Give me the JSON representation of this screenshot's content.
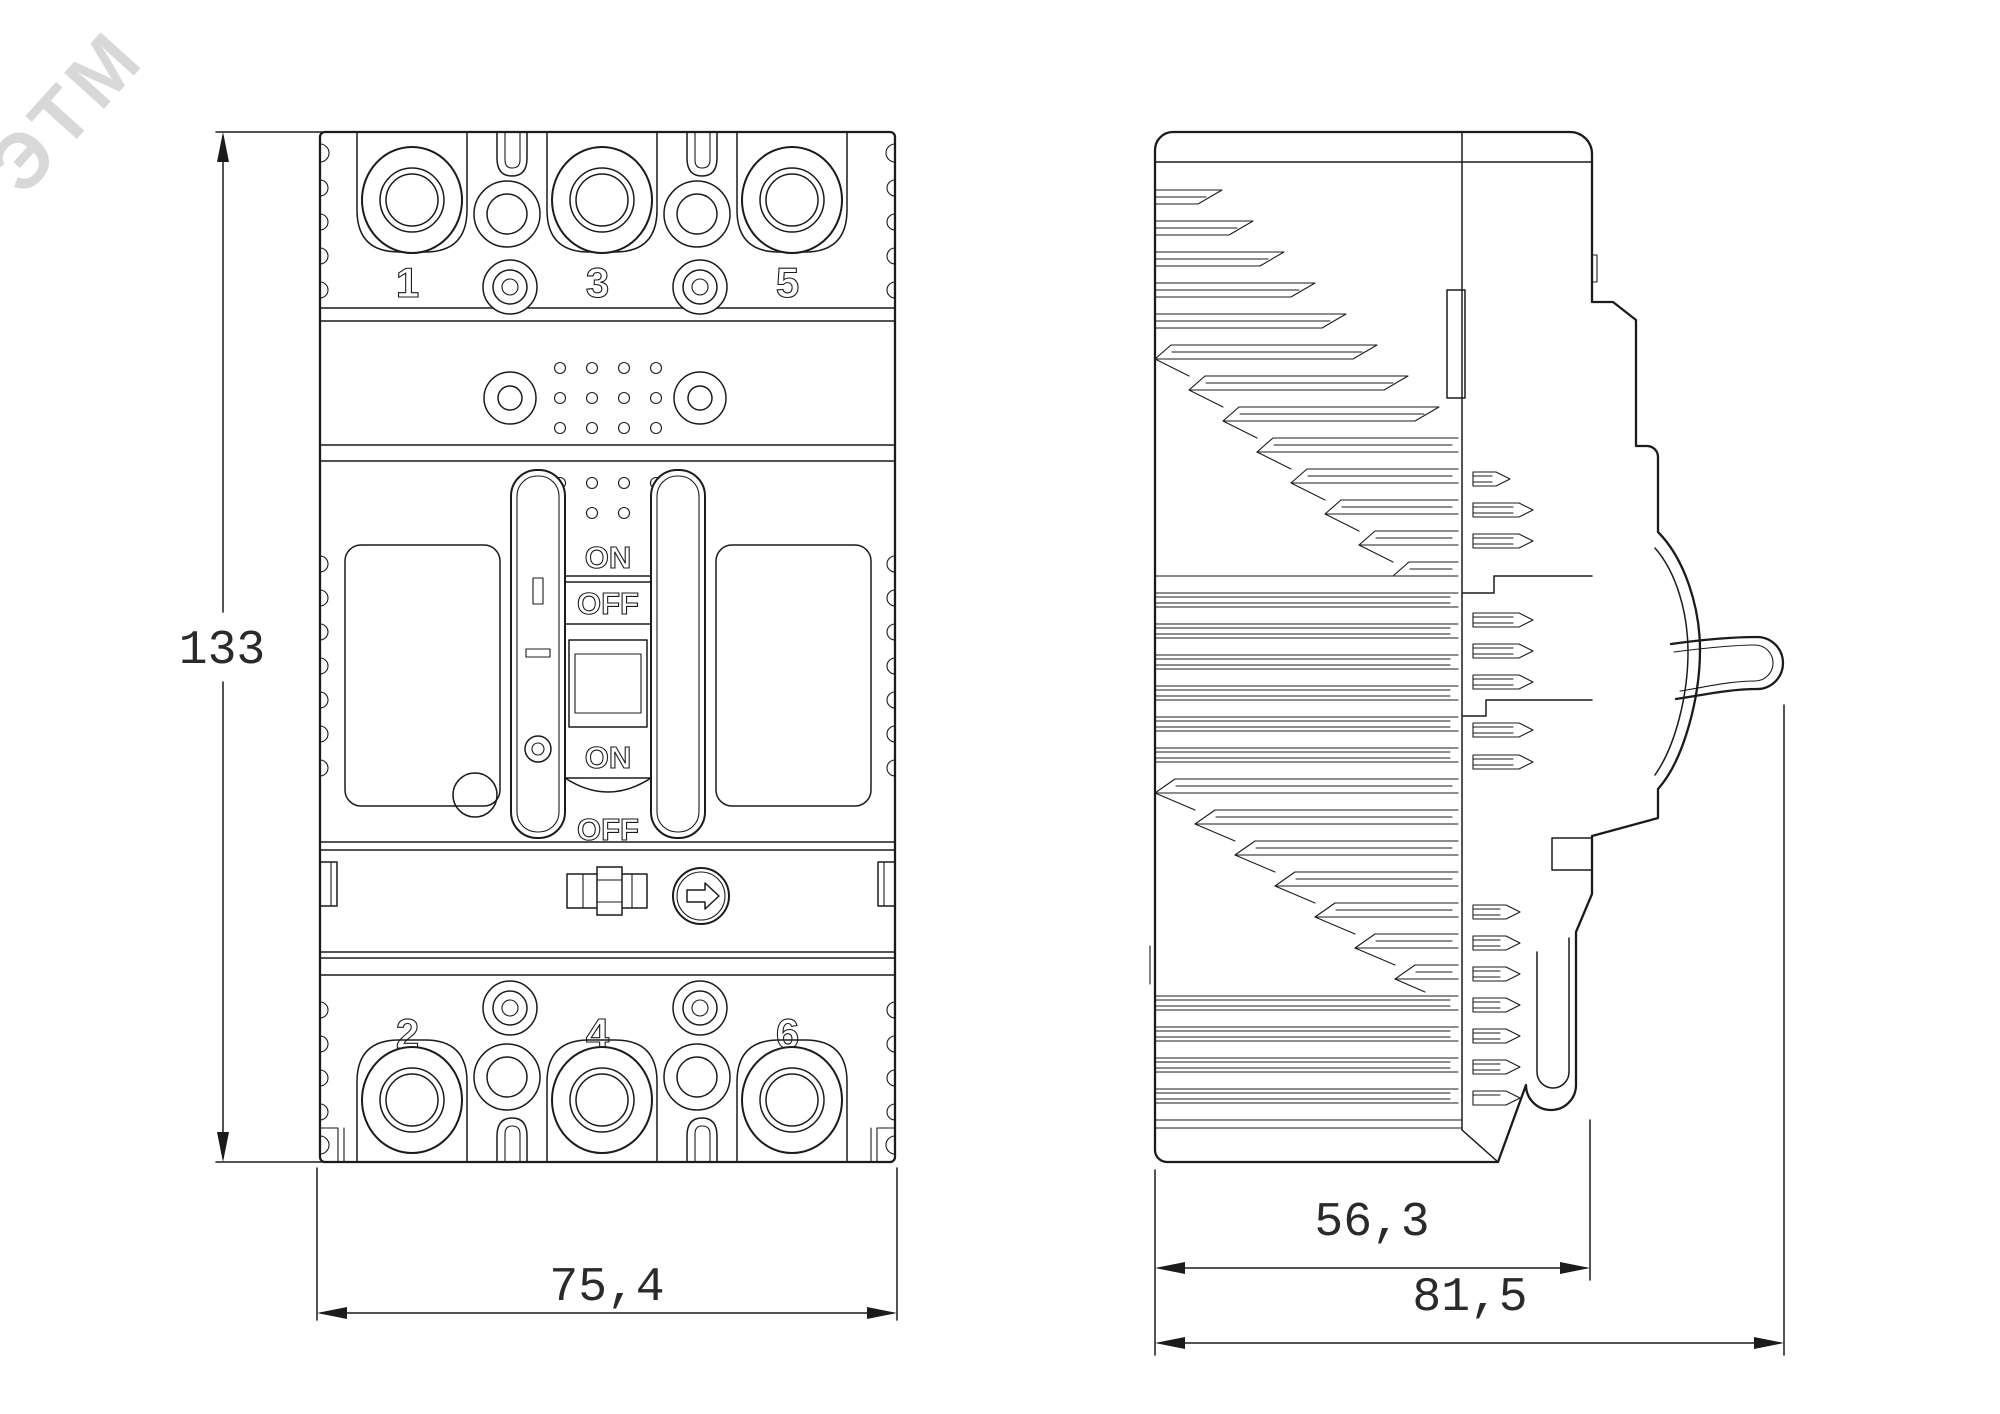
{
  "watermark": {
    "text": "ЭТМ"
  },
  "front_view": {
    "terminal_labels_top": [
      "1",
      "3",
      "5"
    ],
    "terminal_labels_bottom": [
      "2",
      "4",
      "6"
    ],
    "switch_markings": {
      "on": "ON",
      "off": "OFF"
    }
  },
  "dimensions": {
    "height": "133",
    "width": "75,4",
    "depth_body": "56,3",
    "depth_overall": "81,5"
  },
  "style": {
    "line_color": "#1b1b1b",
    "background": "#ffffff",
    "watermark_color": "#d2d2d2"
  }
}
